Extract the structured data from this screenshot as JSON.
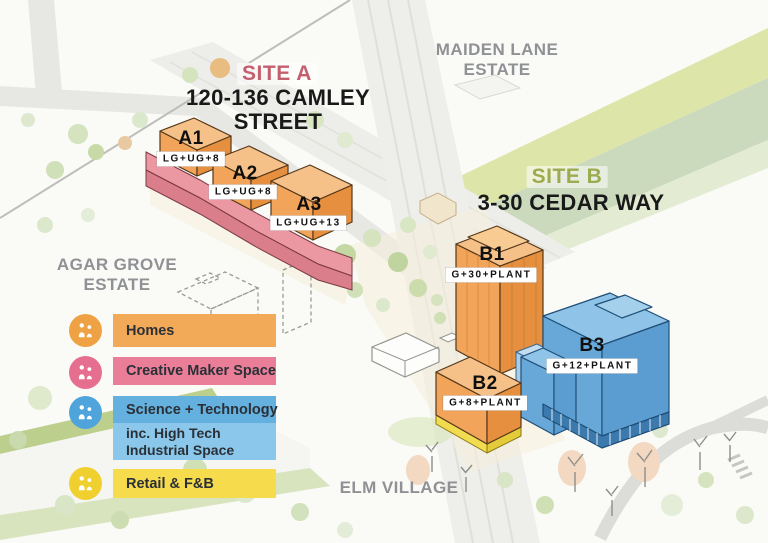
{
  "palette": {
    "homes_orange": "#F2A45A",
    "creative_maker_pink": "#EC98A3",
    "science_tech_blue": "#5E9FD3",
    "high_tech_light_blue": "#8AC7EA",
    "retail_yellow": "#F3DC4E",
    "site_a_accent": "#C4606E",
    "site_b_accent": "#9DAB4F",
    "area_label_gray": "#8F9195"
  },
  "site_a": {
    "tag": "SITE A",
    "title_line1": "120-136 CAMLEY",
    "title_line2": "STREET"
  },
  "site_b": {
    "tag": "SITE B",
    "title": "3-30 CEDAR WAY"
  },
  "areas": {
    "maiden_lane_line1": "MAIDEN LANE",
    "maiden_lane_line2": "ESTATE",
    "agar_grove_line1": "AGAR GROVE",
    "agar_grove_line2": "ESTATE",
    "elm_village": "ELM VILLAGE"
  },
  "buildings": [
    {
      "id": "A1",
      "floors": "LG+UG+8"
    },
    {
      "id": "A2",
      "floors": "LG+UG+8"
    },
    {
      "id": "A3",
      "floors": "LG+UG+13"
    },
    {
      "id": "B1",
      "floors": "G+30+PLANT"
    },
    {
      "id": "B2",
      "floors": "G+8+PLANT"
    },
    {
      "id": "B3",
      "floors": "G+12+PLANT"
    }
  ],
  "legend": {
    "items": [
      {
        "label": "Homes",
        "icon": "homes-people-icon",
        "color": "#F2A958"
      },
      {
        "label": "Creative Maker Space",
        "icon": "creative-maker-people-icon",
        "color": "#EA7D98"
      },
      {
        "label": "Science + Technology",
        "sub_label": "inc. High Tech Industrial Space",
        "icon": "science-people-icon",
        "color": "#64B0DE",
        "sub_color": "#8AC7EA"
      },
      {
        "label": "Retail & F&B",
        "icon": "retail-people-icon",
        "color": "#F6DC4D"
      }
    ]
  }
}
